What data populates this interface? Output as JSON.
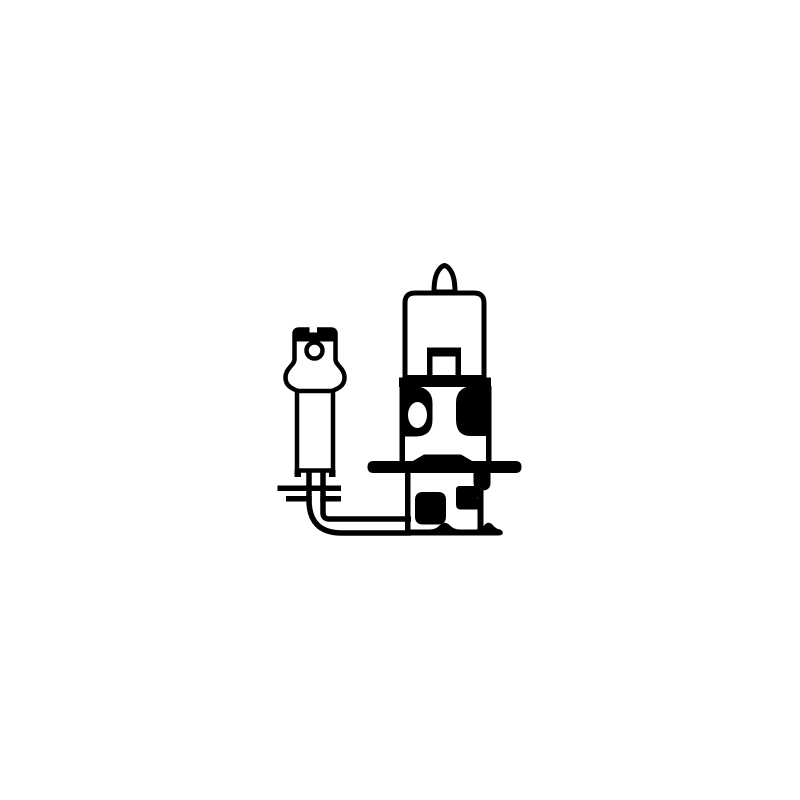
{
  "meta": {
    "subject": "H3 halogen automotive bulb with wire lead and flat spade terminal",
    "style": "black-and-white technical line drawing on plain white background",
    "background_color": "#ffffff",
    "ink_color": "#000000",
    "canvas": {
      "width": 800,
      "height": 800
    }
  },
  "parts": {
    "tip_label": "glass tip",
    "envelope_label": "glass envelope",
    "mount_label": "filament mount",
    "collar_label": "base collar",
    "flange_label": "mounting flange disc",
    "base_label": "metal base",
    "wire_label": "wire lead with 90-degree bend",
    "terminal_label": "flat spade connector with hole",
    "sleeve_label": "insulating sleeve",
    "washer_label": "seal washer"
  },
  "paths": {
    "tip": "M434 292 Q434 277 438.5 270.5 Q441.5 266 444.5 265.5 Q447.5 266 450.5 270.5 Q455 277 455 292 Z",
    "glass_envelope": "M415 293 H474 Q484 293 484 303 V377.5 H405 V303 Q405 293 415 293 Z",
    "filament_mount": "M427 347.5 H461 V378 H455.5 V356.5 H432.5 V378 H427 Z",
    "junction_bar": "M399 377.5 H491 V387 H399 Z",
    "upper_wall_left": "M399.5 386 H405 V473 H399.5 Z",
    "upper_wall_right": "M486 386 H491.5 V473 H486 Z",
    "upper_mass_left": "M402 386 H416 Q432.5 388.5 432.5 403 V419.5 Q432.5 436.5 415.5 436.5 H402 Z M408 415 A9.5 13 0 1 0 427 415 A9.5 13 0 1 0 408 415 Z",
    "upper_mass_right": "M491 386 H470.5 Q456 388.5 456 402.5 V419.5 Q456 436 470.5 436 H491 Z",
    "flange_trapezoid": "M412 461.5 L424 454.5 H461 L473 461.5 Z",
    "flange_disc": "M373.5 461 H515.5 Q521.5 461 521.5 467 Q521.5 473 515.5 473 H373.5 Q367.5 473 367.5 467 Q367.5 461 373.5 461 Z",
    "lower_wall_left": "M405 473 H410.5 V534 H405 Z",
    "lower_wall_right": "M477.5 490 H483.5 V531 H477.5 Z",
    "under_flange_right_blob": "M473.5 473 H490.5 V483 Q490.5 490.5 482 490.5 Q473.5 490.5 473.5 482 Z",
    "bottom_edge_wavy": "M405 535.5 V529.5 H429 C434.5 529.5 437 528 440 525 C443 522 446.5 522 449.5 525 C452.5 528 455.5 529.5 460.5 529.5 H475.5 C479.5 529.5 482 528 484.5 525 C487 522 490.5 522 493 525.2 C495.2 527.8 497.2 528.8 499.2 529.2 C501.8 529.8 502.8 531.2 502.8 532.8 C502.8 534.6 501 535.5 498.2 535.5 Z",
    "lower_left_blob": "M423 492 H438 Q446 492 446 500 V516.5 Q446 524.5 438 524.5 H423 Q415 524.5 415 516.5 V500 Q415 492 423 492 Z",
    "lower_center_block": "M459.5 486 H477.5 Q481 486 481 489.5 V493.5 L477 498 L481 502.5 V506 Q481 509.5 477.5 509.5 H461 Q456 509.5 456 504.5 V489.5 Q456 486 459.5 486 Z",
    "sleeve": "M297 390 H333 V470.5 H297 Z",
    "sleeve_foot_left": "M294.5 470 H301 V477 H294.5 Z",
    "sleeve_foot_right": "M329 470 H335.5 V477 H329 Z",
    "terminal_body": "M299 329.5 H331 Q335.5 329.5 335.5 334 V359 Q335.5 361.5 337 363.5 L341.5 369 Q344.5 373 344.5 377.5 Q344.5 385 337.5 388.5 L334 390.3 Q332.5 391 330 391 H300 Q297.5 391 296 390.3 L292.5 388.5 Q285.5 385 285.5 377.5 Q285.5 373 288.5 369 L293 363.5 Q294.5 361.5 294.5 359 V334 Q294.5 329.5 299 329.5 Z",
    "terminal_top_bar": "M292.5 334.5 Q292.5 327.5 299.5 327.5 H330.5 Q337.5 327.5 337.5 334.5 V337.5 Q337.5 341.5 332.5 341.5 H297.5 Q292.5 341.5 292.5 337.5 Z",
    "terminal_notch": "M309.5 325 H317 V332.5 H309.5 Z",
    "terminal_tab": "M310.5 338 H317.5 V344 H310.5 Z",
    "terminal_hole": "M306.5 350.5 A8 8 0 1 0 322.5 350.5 A8 8 0 1 0 306.5 350.5 Z",
    "wire_outer": "M309 469 V500 Q309 533 342 533 H411",
    "wire_inner": "M323 469 V513 Q323 519 329.5 519 H411",
    "washer_top_line": "M277.5 485.5 H341 V491 H277.5 Z",
    "washer_bottom_left": "M286 496 H311.7 V501.5 H286 Z",
    "washer_bottom_right": "M320.3 496 H341 V501.5 H320.3 Z"
  }
}
